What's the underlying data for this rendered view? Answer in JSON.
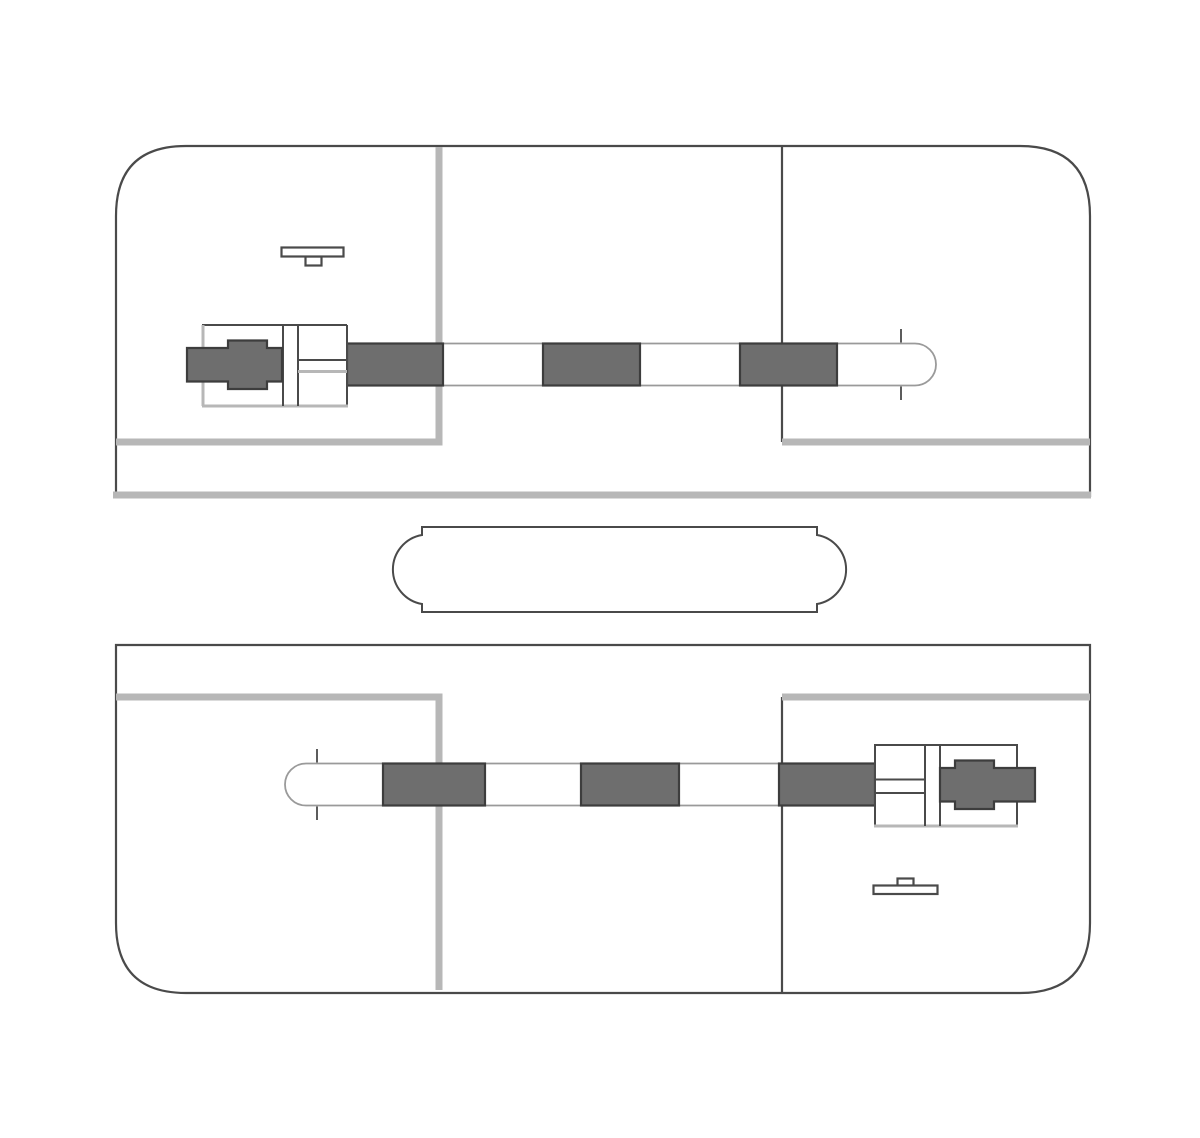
{
  "canvas": {
    "width": 1200,
    "height": 1138
  },
  "colors": {
    "background": "#ffffff",
    "line_dark": "#4a4a4a",
    "line_gray": "#b7b7b7",
    "arm_outline": "#9a9a9a",
    "segment_fill": "#6e6e6e",
    "segment_border": "#3d3d3d",
    "shape_fill": "#ffffff"
  },
  "diagram": {
    "type": "level-crossing-plan",
    "upper_panel": {
      "barrier_arm": {
        "dark_stripe_count": 3,
        "hinge_side": "left",
        "tip": "rounded-right"
      },
      "gate_machine": "left",
      "sign_marker": "bar-with-post-below"
    },
    "lower_panel": {
      "barrier_arm": {
        "dark_stripe_count": 3,
        "hinge_side": "right",
        "tip": "rounded-left"
      },
      "gate_machine": "right",
      "sign_marker": "bar-with-post-above"
    },
    "median_island": {
      "shape": "stadium-with-stepped-ends"
    }
  }
}
